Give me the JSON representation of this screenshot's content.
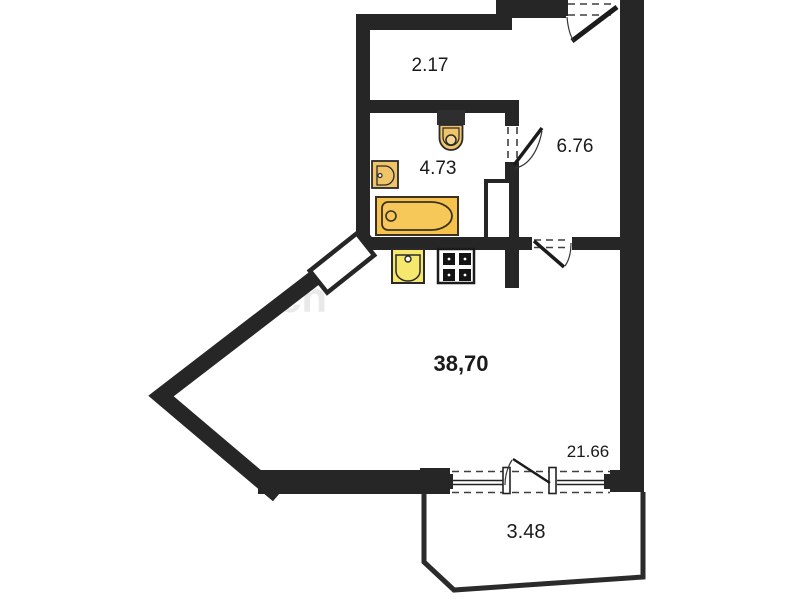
{
  "labels": {
    "corridor": "2.17",
    "bathroom": "4.73",
    "hallway": "6.76",
    "living_room": "38,70",
    "window_zone": "21.66",
    "balcony": "3.48"
  },
  "watermark": "ch",
  "fixtures": [
    "toilet-icon",
    "washbasin-icon",
    "bathtub-icon",
    "kitchen-sink-icon",
    "stove-icon"
  ],
  "colors": {
    "wall": "#262626",
    "fixture_fill": "#f0c469",
    "bathtub_fill": "#f5c24b",
    "kitchen_sink_fill": "#f6e76e",
    "stove_burner": "#141414",
    "balcony_outline": "#2b2b2b",
    "dashed_opening": "#3f3f3f",
    "label_text": "#1a1a1a",
    "watermark": "#d8d8d8"
  }
}
